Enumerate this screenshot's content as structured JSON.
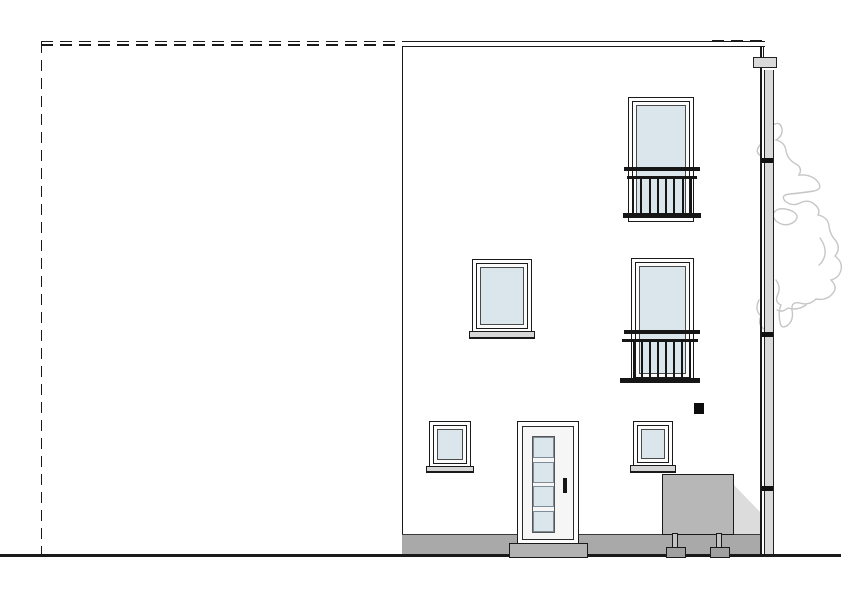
{
  "drawing": {
    "kind": "building-street-elevation",
    "visible_text": [],
    "elements": [
      {
        "name": "neighbor-building-outline",
        "linestyle": "dashed"
      },
      {
        "name": "building-facade",
        "storeys": 3
      },
      {
        "name": "roof-parapet-line"
      },
      {
        "name": "french-window-top-floor"
      },
      {
        "name": "juliet-balcony-railing-top",
        "bars": 8
      },
      {
        "name": "window-middle-floor"
      },
      {
        "name": "french-window-middle-floor"
      },
      {
        "name": "juliet-balcony-railing-middle",
        "bars": 8
      },
      {
        "name": "window-ground-left"
      },
      {
        "name": "entry-door",
        "glass_panes": 4
      },
      {
        "name": "window-ground-right"
      },
      {
        "name": "wall-lamp"
      },
      {
        "name": "utility-box",
        "feet": 2
      },
      {
        "name": "utility-box-shadow"
      },
      {
        "name": "door-step"
      },
      {
        "name": "plinth-base"
      },
      {
        "name": "ground-line"
      },
      {
        "name": "rain-downpipe",
        "clamps": 3
      },
      {
        "name": "gutter-elbow"
      },
      {
        "name": "tree-outline"
      }
    ]
  },
  "colors": {
    "background": "#ffffff",
    "line": "#1a1a1a",
    "glass": "#dbe5ec",
    "door_face": "#f6f6f6",
    "plinth_gray": "#a9a9a9",
    "step_gray": "#b2b2b2",
    "box_gray": "#b7b7b7",
    "foot_gray": "#a0a0a0",
    "shadow_gray": "#dcdcdc",
    "pipe_gray": "#d9d9d9",
    "sill_gray": "#d6d6d6",
    "tree_outline": "#c6c6c6",
    "railing": "#161616"
  }
}
